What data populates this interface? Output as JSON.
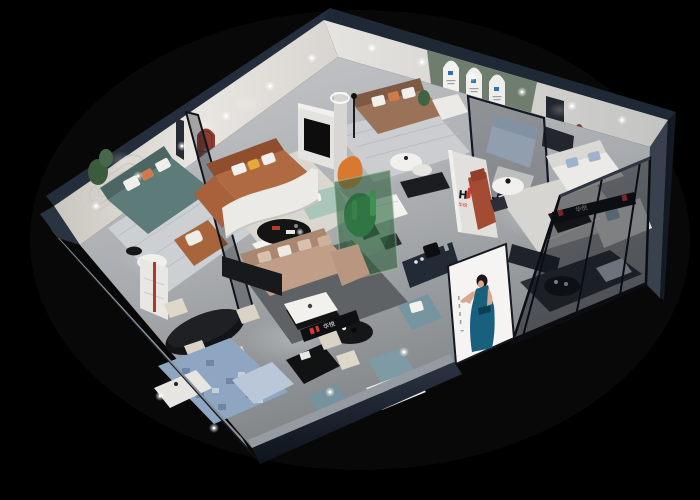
{
  "scene": {
    "description": "Isometric cutaway 3D render of a furniture showroom interior on a black background",
    "background_color": "#000000"
  },
  "brand": {
    "mark": "H",
    "name": "华悦",
    "red": "#d93a2b",
    "dark": "#14161a"
  },
  "signs": {
    "wall_logo_name": "华悦",
    "ledge_sign_name": "华悦",
    "hanging_sign_name": "华悦"
  },
  "gallery": {
    "poster_count": 3,
    "poster_logo_color": "#2f6fb5",
    "wall_color": "#6f7d6e"
  },
  "lightbox_poster": {
    "subject": "woman in teal evening dress",
    "panel_color": "#f5f4f2",
    "dress_color": "#19607f"
  },
  "palette": {
    "outer_wall_navy": "#1c2431",
    "inner_wall_white": "#e2e0dc",
    "floor_gray": "#b3b6b9",
    "accent_red": "#b03a2e",
    "cognac_sofa": "#b06a42",
    "teal_sofa": "#5d7b78",
    "tan_sofa": "#c09e88",
    "taupe_sofa": "#9a7258",
    "mint_sofa": "#aac6bb",
    "blue_rug": "#8fa6c2",
    "ottoman_teal": "#7e9aa4",
    "terrarium_green": "#2e6b3f"
  }
}
